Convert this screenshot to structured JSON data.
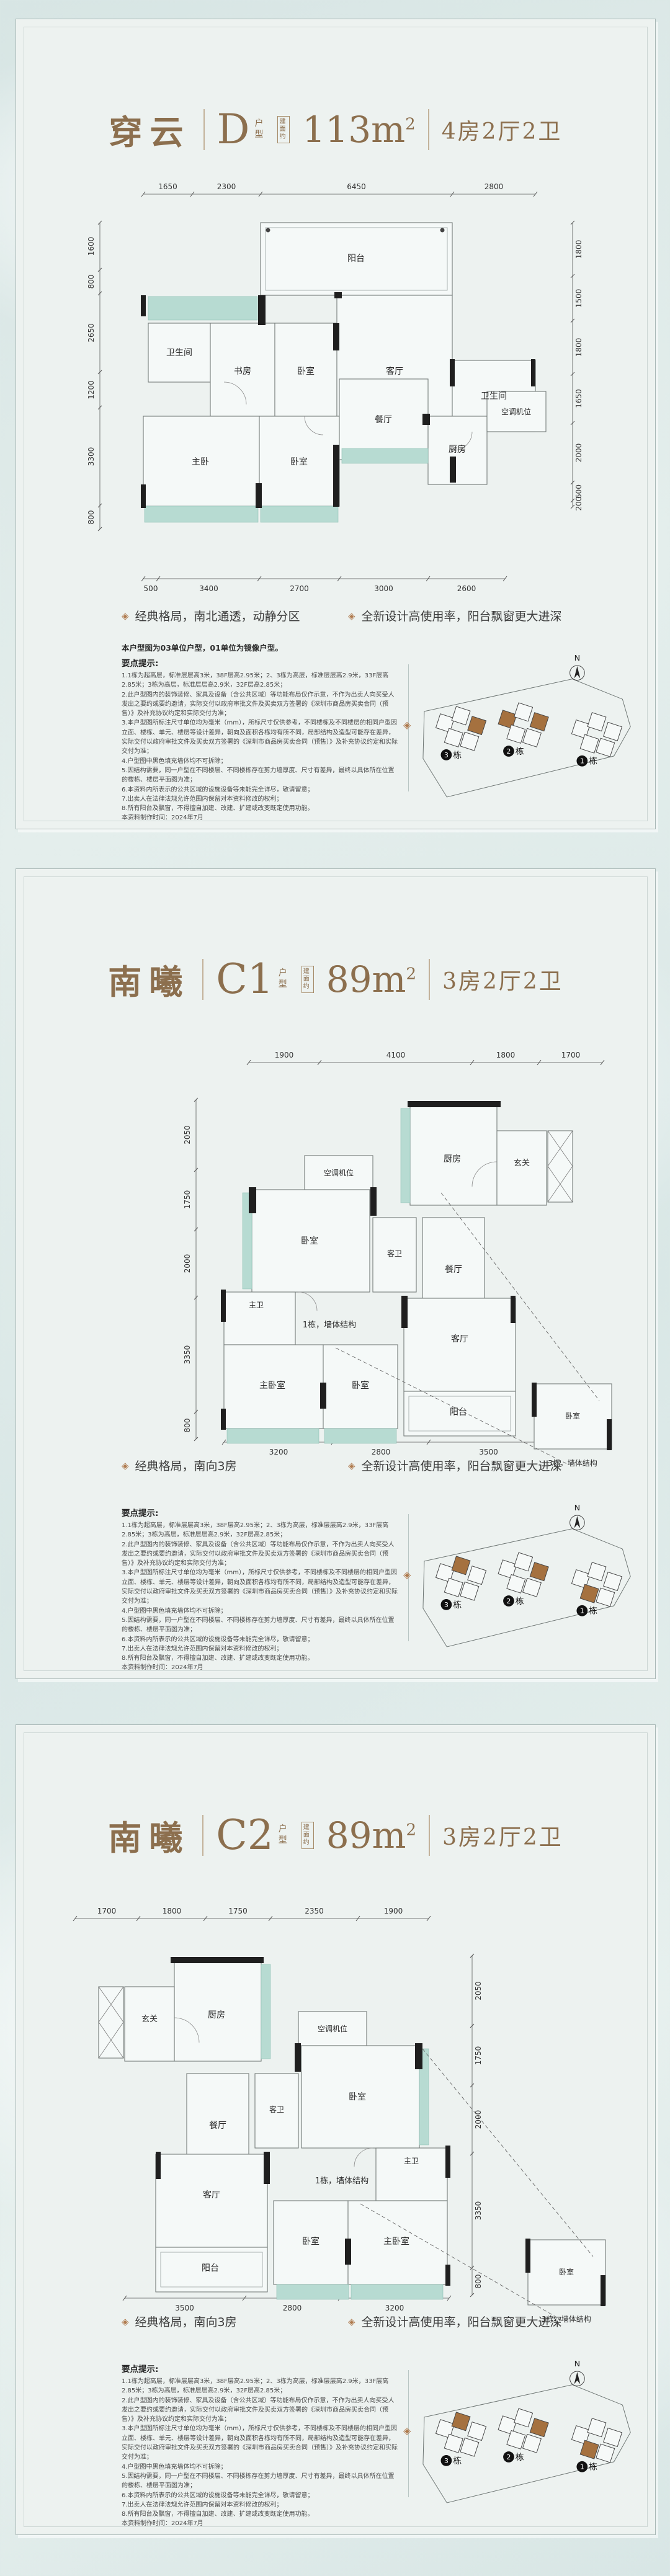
{
  "shared": {
    "tips_heading": "要点提示:",
    "disclaimer_lines": [
      "1.1栋为超高层，标准层层高3米，38F层高2.95米；2、3栋为高层，标准层层高2.9米，33F层高2.85米；3栋为高层，标准层层高2.9米，32F层高2.85米；",
      "2.此户型图内的装饰装修、家具及设备（含公共区域）等功能布局仅作示意，不作为出卖人向买受人发出之要约或要约邀请，实际交付以政府审批文件及买卖双方签署的《深圳市商品房买卖合同（预售）》及补充协议约定和实际交付为准；",
      "3.本户型图所标注尺寸单位均为毫米（mm），所标尺寸仅供参考，不同楼栋及不同楼层的相同户型因立面、楼栋、单元、楼层等设计差异，朝向及面积各栋均有所不同，局部结构及造型可能存在差异，实际交付以政府审批文件及买卖双方签署的《深圳市商品房买卖合同（预售）》及补充协议约定和实际交付为准；",
      "4.户型图中黑色填充墙体均不可拆除；",
      "5.因结构需要，同一户型在不同楼层、不同楼栋存在剪力墙厚度、尺寸有差异，最终以具体所在位置的楼栋、楼层平面图为准；",
      "6.本资料内所表示的公共区域的设施设备等未能完全详尽，敬请留意；",
      "7.出卖人在法律法规允许范围内保留对本资料修改的权利；",
      "8.所有阳台及飘窗，不得擅自加建、改建、扩建或改变既定使用功能。"
    ],
    "made_date": "本资料制作时间：2024年7月",
    "colors": {
      "title_brown": "#8c6f4e",
      "diamond_brown": "#b07c50",
      "bay_teal": "#b7dbd2",
      "wall_black": "#1f1f1f"
    }
  },
  "panels": [
    {
      "name": "穿云",
      "type_code": "D",
      "type_suffix": "户型",
      "area_badge": "建面约",
      "area_value": "113m",
      "area_sup": "2",
      "rooms_spec": "4房2厅2卫",
      "bullets": [
        "经典格局，南北通透，动静分区",
        "全新设计高使用率，阳台飘窗更大进深"
      ],
      "note": "本户型图为03单位户型，01单位为镜像户型。",
      "plan": {
        "dims_top": [
          "1650",
          "2300",
          "6450",
          "2800"
        ],
        "dims_bottom": [
          "500",
          "3400",
          "2700",
          "3000",
          "2600"
        ],
        "dims_left": [
          "1600",
          "800",
          "2650",
          "1200",
          "3300",
          "800"
        ],
        "dims_right": [
          "1800",
          "1500",
          "1800",
          "1650",
          "2000",
          "600",
          "200"
        ],
        "rooms": {
          "balcony": "阳台",
          "bath_left": "卫生间",
          "study": "书房",
          "bedroom_top": "卧室",
          "living": "客厅",
          "bath_right": "卫生间",
          "master": "主卧",
          "bedroom_bottom": "卧室",
          "dining": "餐厅",
          "kitchen": "厨房",
          "ac": "空调机位"
        }
      },
      "site_plan": {
        "north": "N",
        "buildings": [
          {
            "number": "3",
            "suffix": "栋",
            "has_highlight": true
          },
          {
            "number": "2",
            "suffix": "栋",
            "has_highlight": true
          },
          {
            "number": "1",
            "suffix": "栋",
            "has_highlight": false
          }
        ]
      }
    },
    {
      "name": "南曦",
      "type_code": "C1",
      "type_suffix": "户型",
      "area_badge": "建面约",
      "area_value": "89m",
      "area_sup": "2",
      "rooms_spec": "3房2厅2卫",
      "bullets": [
        "经典格局，南向3房",
        "全新设计高使用率，阳台飘窗更大进深"
      ],
      "note": "",
      "plan": {
        "dims_top": [
          "1900",
          "4100",
          "1800",
          "1700"
        ],
        "dims_bottom": [
          "3200",
          "2800",
          "3500"
        ],
        "dims_left": [
          "2050",
          "1750",
          "2000",
          "3350",
          "800"
        ],
        "dims_right": [],
        "rooms": {
          "ac": "空调机位",
          "kitchen": "厨房",
          "entry": "玄关",
          "bedroom_top": "卧室",
          "guest_bath": "客卫",
          "dining": "餐厅",
          "master_bath": "主卫",
          "master": "主卧室",
          "bedroom_mid": "卧室",
          "living": "客厅",
          "balcony": "阳台",
          "detached_bedroom": "卧室",
          "anno_b1": "1栋，墙体结构",
          "anno_b3": "3栋，墙体结构"
        }
      },
      "site_plan": {
        "north": "N",
        "buildings": [
          {
            "number": "3",
            "suffix": "栋",
            "has_highlight": true
          },
          {
            "number": "2",
            "suffix": "栋",
            "has_highlight": true
          },
          {
            "number": "1",
            "suffix": "栋",
            "has_highlight": true
          }
        ]
      }
    },
    {
      "name": "南曦",
      "type_code": "C2",
      "type_suffix": "户型",
      "area_badge": "建面约",
      "area_value": "89m",
      "area_sup": "2",
      "rooms_spec": "3房2厅2卫",
      "bullets": [
        "经典格局，南向3房",
        "全新设计高使用率，阳台飘窗更大进深"
      ],
      "note": "",
      "plan": {
        "dims_top": [
          "1700",
          "1800",
          "1750",
          "2350",
          "1900"
        ],
        "dims_bottom": [
          "3500",
          "2800",
          "3200"
        ],
        "dims_left": [],
        "dims_right": [
          "2050",
          "1750",
          "2000",
          "3350",
          "800"
        ],
        "rooms": {
          "entry": "玄关",
          "kitchen": "厨房",
          "ac": "空调机位",
          "dining": "餐厅",
          "guest_bath": "客卫",
          "bedroom_top": "卧室",
          "master_bath": "主卫",
          "living": "客厅",
          "bedroom_mid": "卧室",
          "master": "主卧室",
          "balcony": "阳台",
          "detached_bedroom": "卧室",
          "anno_b1": "1栋，墙体结构",
          "anno_b3": "3栋，墙体结构"
        }
      },
      "site_plan": {
        "north": "N",
        "buildings": [
          {
            "number": "3",
            "suffix": "栋",
            "has_highlight": true
          },
          {
            "number": "2",
            "suffix": "栋",
            "has_highlight": true
          },
          {
            "number": "1",
            "suffix": "栋",
            "has_highlight": true
          }
        ]
      }
    }
  ]
}
